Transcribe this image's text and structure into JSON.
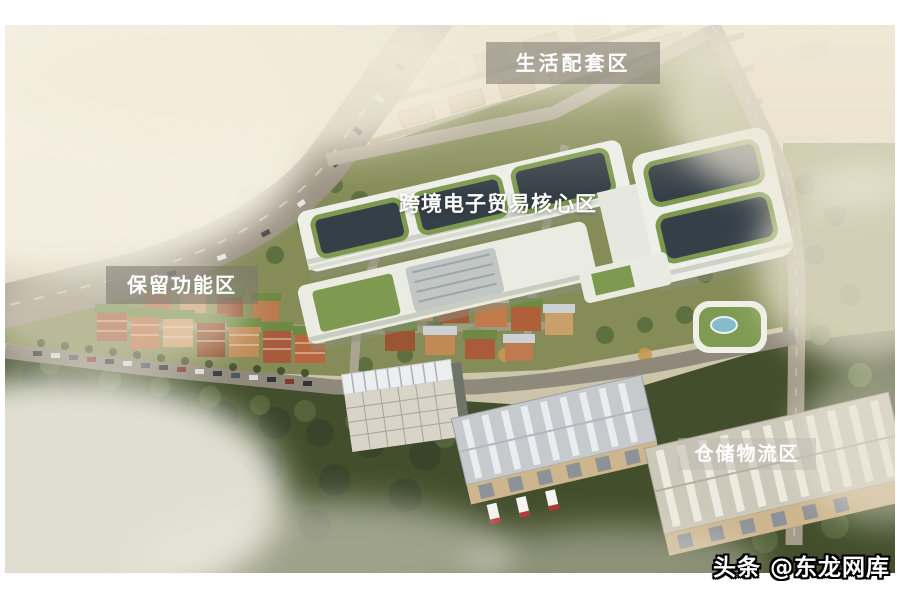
{
  "page": {
    "background": "#ffffff"
  },
  "photo": {
    "description": "Aerial architectural rendering of an industrial park master plan with labeled functional zones",
    "zones": {
      "living": {
        "label": "生活配套区"
      },
      "core": {
        "label": "跨境电子贸易核心区"
      },
      "reserved": {
        "label": "保留功能区"
      },
      "warehouse": {
        "label": "仓储物流区"
      }
    },
    "watermark": {
      "text": "头条 @东龙网库"
    },
    "colors": {
      "haze": "#e8ddc6",
      "label_text": "#ffffff",
      "label_bg": "rgba(120,116,108,0.55)",
      "site_green": "#858c58",
      "forest": "#434f2c",
      "building_white": "#edefe8",
      "courtyard_glass": "#353f47",
      "green_roof": "#7d9a50",
      "brick": "#b5714b",
      "road": "#9a9283",
      "warehouse_roof": "#c6cacd",
      "pool_blue": "#85bccc"
    }
  }
}
